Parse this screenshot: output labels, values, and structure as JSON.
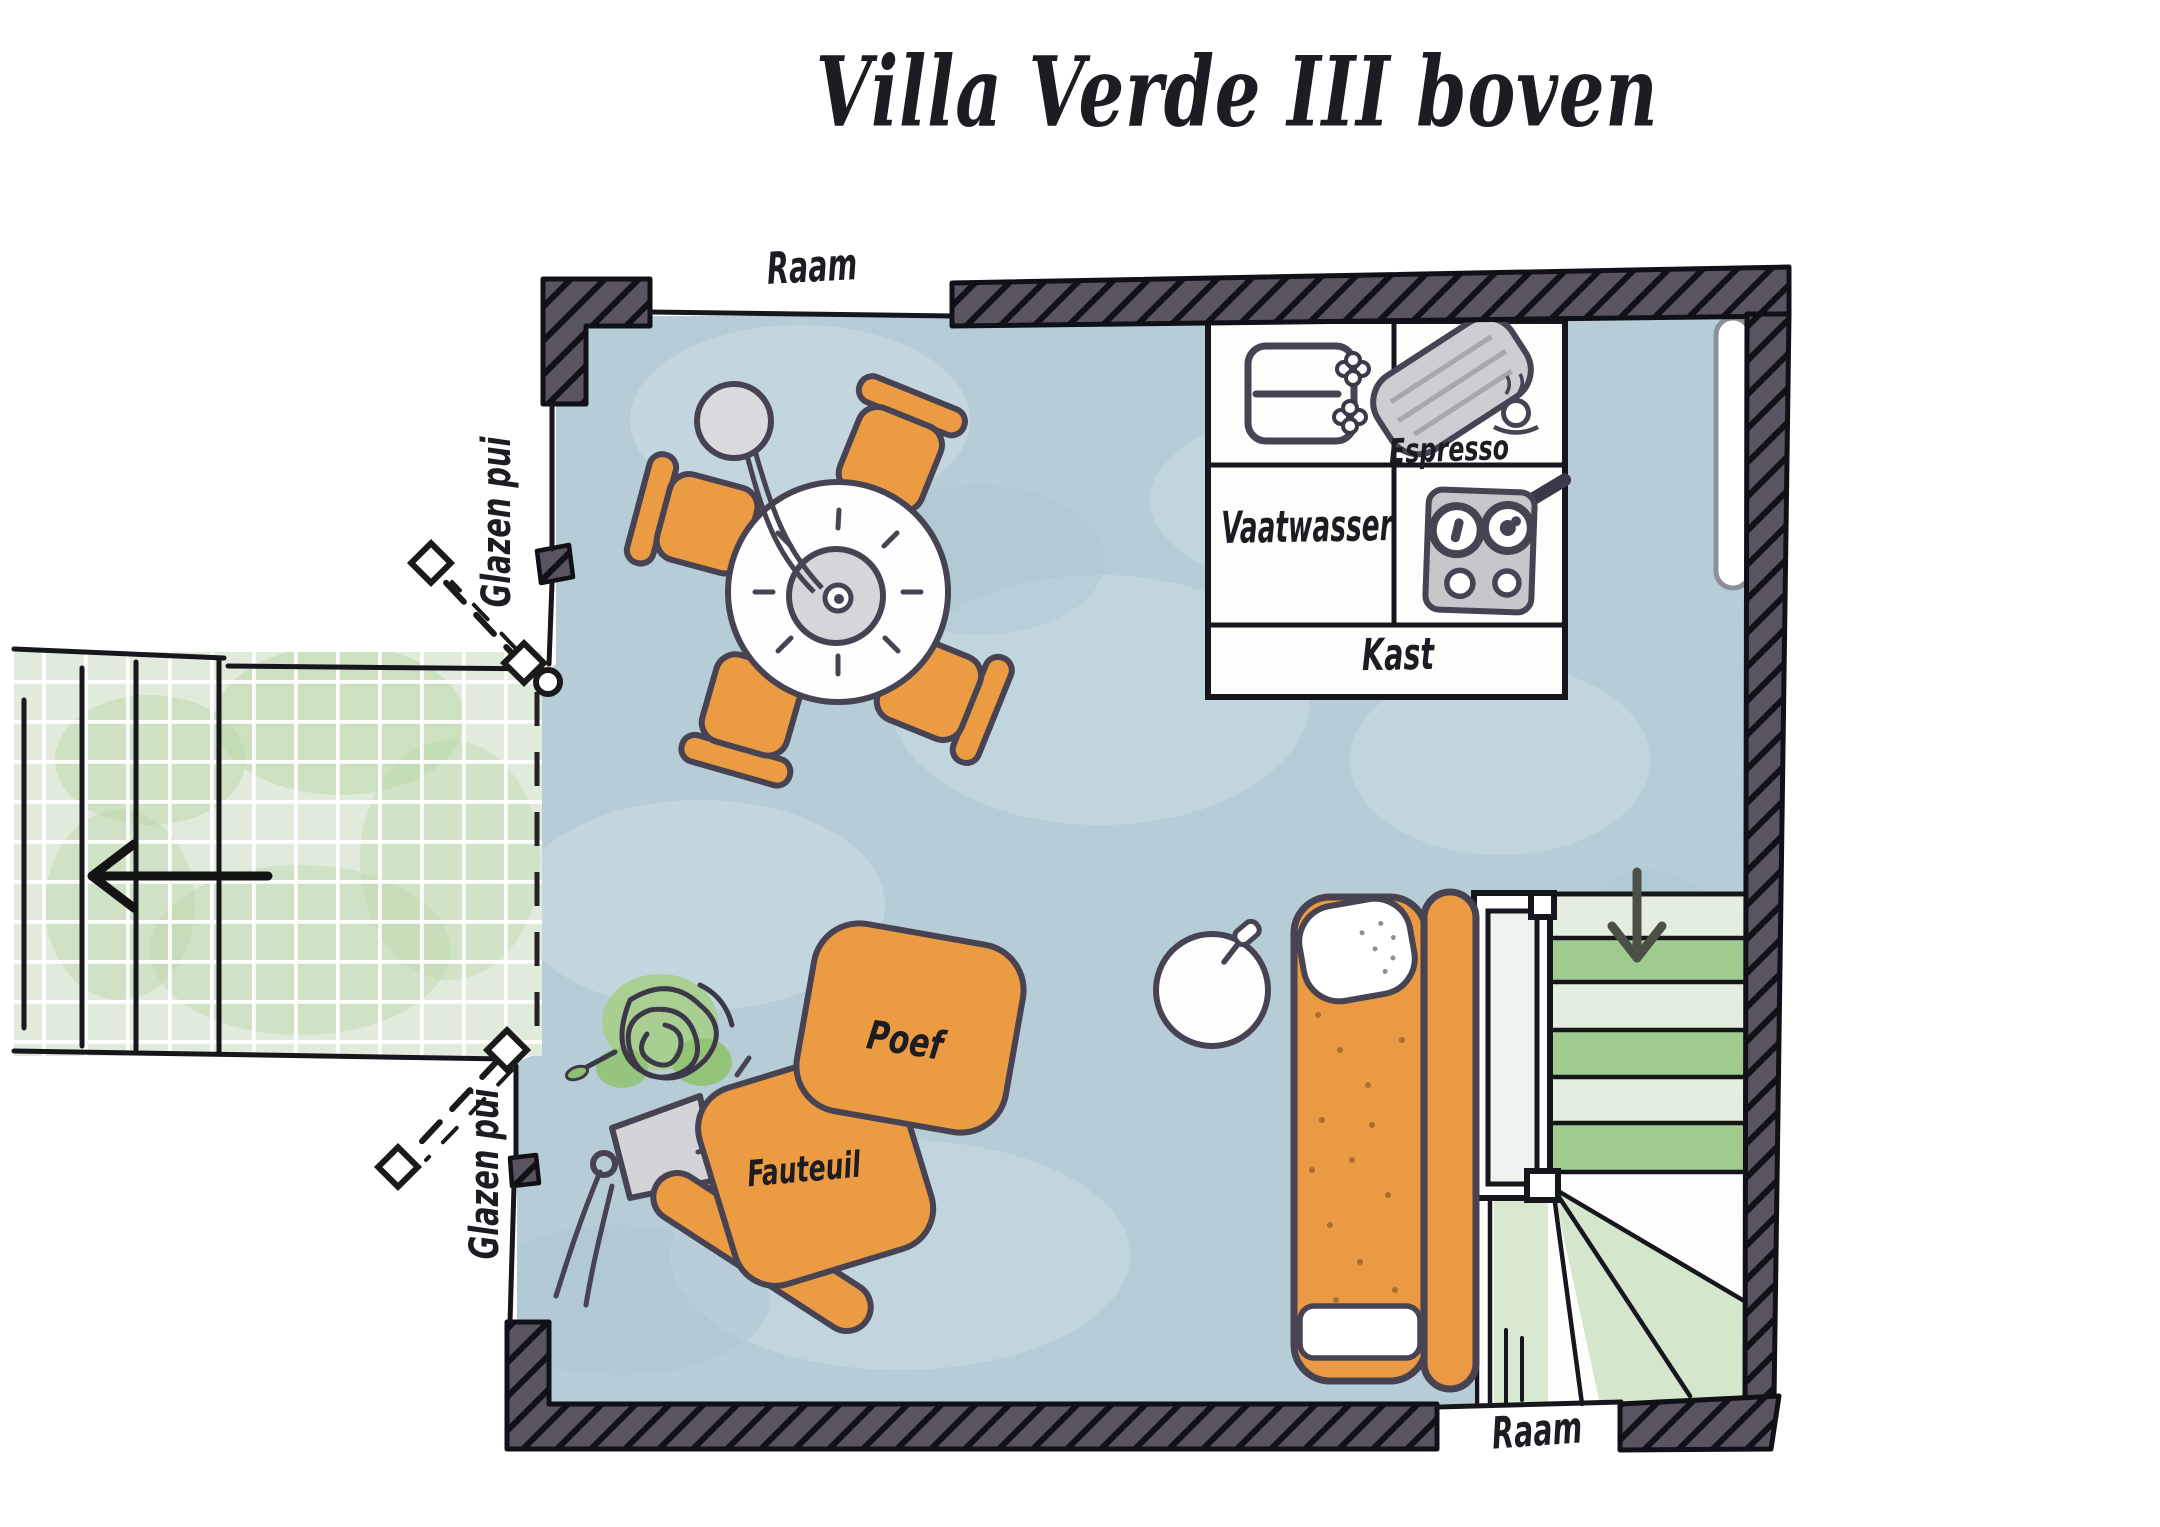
{
  "title": "Villa Verde III boven",
  "labels": {
    "window_top": "Raam",
    "window_bottom": "Raam",
    "glass_facade_upper": "Glazen pui",
    "glass_facade_lower": "Glazen pui"
  },
  "kitchen": {
    "espresso": "Espresso",
    "dishwasher": "Vaatwasser",
    "cupboard": "Kast"
  },
  "living": {
    "pouf": "Poef",
    "armchair": "Fauteuil"
  },
  "icons": {
    "terrace_exit": "arrow-left-icon",
    "stairs_down": "arrow-down-icon"
  },
  "colors": {
    "floor": "#b6cdd7",
    "terrace": "#e0ebdb",
    "stair_green": "#96c583",
    "wall": "#5a5360",
    "outline": "#16161d",
    "furniture_orange": "#ea9a43",
    "appliance_gray": "#cdcdd2"
  }
}
